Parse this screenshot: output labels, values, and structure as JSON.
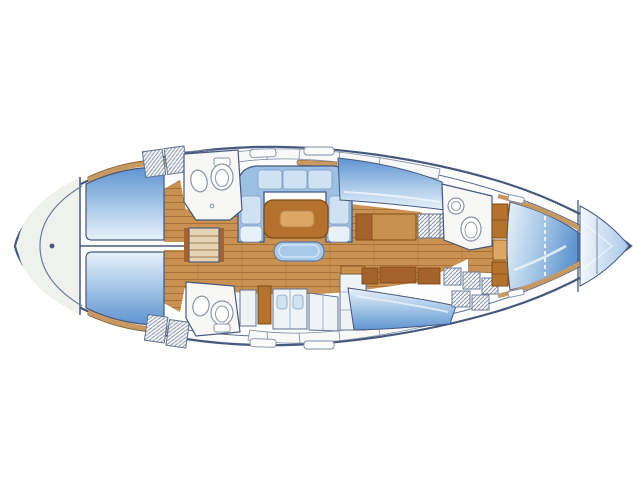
{
  "figure": {
    "kind": "sailing-yacht-interior-floor-plan",
    "view": "top-down",
    "bow_direction": "right",
    "visible_text": ""
  },
  "palette": {
    "outline": "#46587e",
    "hull_fill": "#fcfdfc",
    "stern_cap": "#eff1ed",
    "bed_dark": "#5f94d0",
    "bed_mid": "#a9c9e8",
    "bed_light": "#e9f2fa",
    "wood_floor": "#ca9252",
    "wood_floor_line": "#a9713a",
    "furniture_wood": "#c9914f",
    "furniture_dark": "#a5622a",
    "table_wood": "#b5722f",
    "table_inset": "#dca763",
    "trim_wood": "#c89a62",
    "settee_back": "#9cc0e4",
    "cushion": "#cfe2f3",
    "cushion_light": "#e8f1f9",
    "counter": "#eef3f6",
    "counter_sink": "#cfe3f0",
    "room_white": "#f7f8f6",
    "fixture_white": "#ffffff",
    "fixture_stroke": "#8a93a8",
    "hatch_gray": "#7a879e",
    "deck_band": "#f8f9f6",
    "anchor_light": "#f2f7fb"
  },
  "icons": {
    "toilet": "toilet-icon",
    "sink": "sink-icon",
    "steps": "companionway-steps-icon",
    "table": "salon-table",
    "berth": "double-berth"
  }
}
